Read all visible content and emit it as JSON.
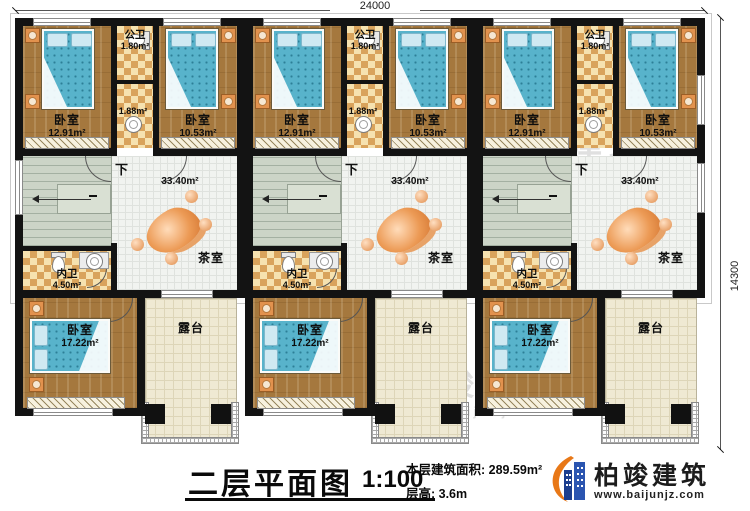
{
  "plan": {
    "dim_top": "24000",
    "dim_right": "14300",
    "rooms": {
      "bedroom_a": {
        "name": "卧室",
        "area": "12.91m²"
      },
      "bedroom_b": {
        "name": "卧室",
        "area": "10.53m²"
      },
      "public_bath": {
        "name": "公卫",
        "area": "1.80m²"
      },
      "hall_bath_area": "1.88m²",
      "tea_room": {
        "name": "茶室",
        "area": "33.40m²"
      },
      "inner_bath": {
        "name": "内卫",
        "area": "4.50m²"
      },
      "bedroom_c": {
        "name": "卧室",
        "area": "17.22m²"
      },
      "terrace": {
        "name": "露台"
      },
      "stair_down": "下"
    }
  },
  "title_block": {
    "title": "二层平面图",
    "scale": "1:100",
    "area_line": "本层建筑面积: 289.59m²",
    "height_line": "层高: 3.6m"
  },
  "brand": {
    "name": "柏竣建筑",
    "website": "www.baijunjz.com"
  },
  "watermark": {
    "name": "柏竣建筑",
    "website": "www.baijunjz.com"
  },
  "colors": {
    "wall": "#131313",
    "wood_floor": "#a5783e",
    "bed": "#58b3cb",
    "bath_tile": "#d9a35c",
    "logo_blue": "#1c3e8e",
    "logo_orange": "#e87817"
  }
}
